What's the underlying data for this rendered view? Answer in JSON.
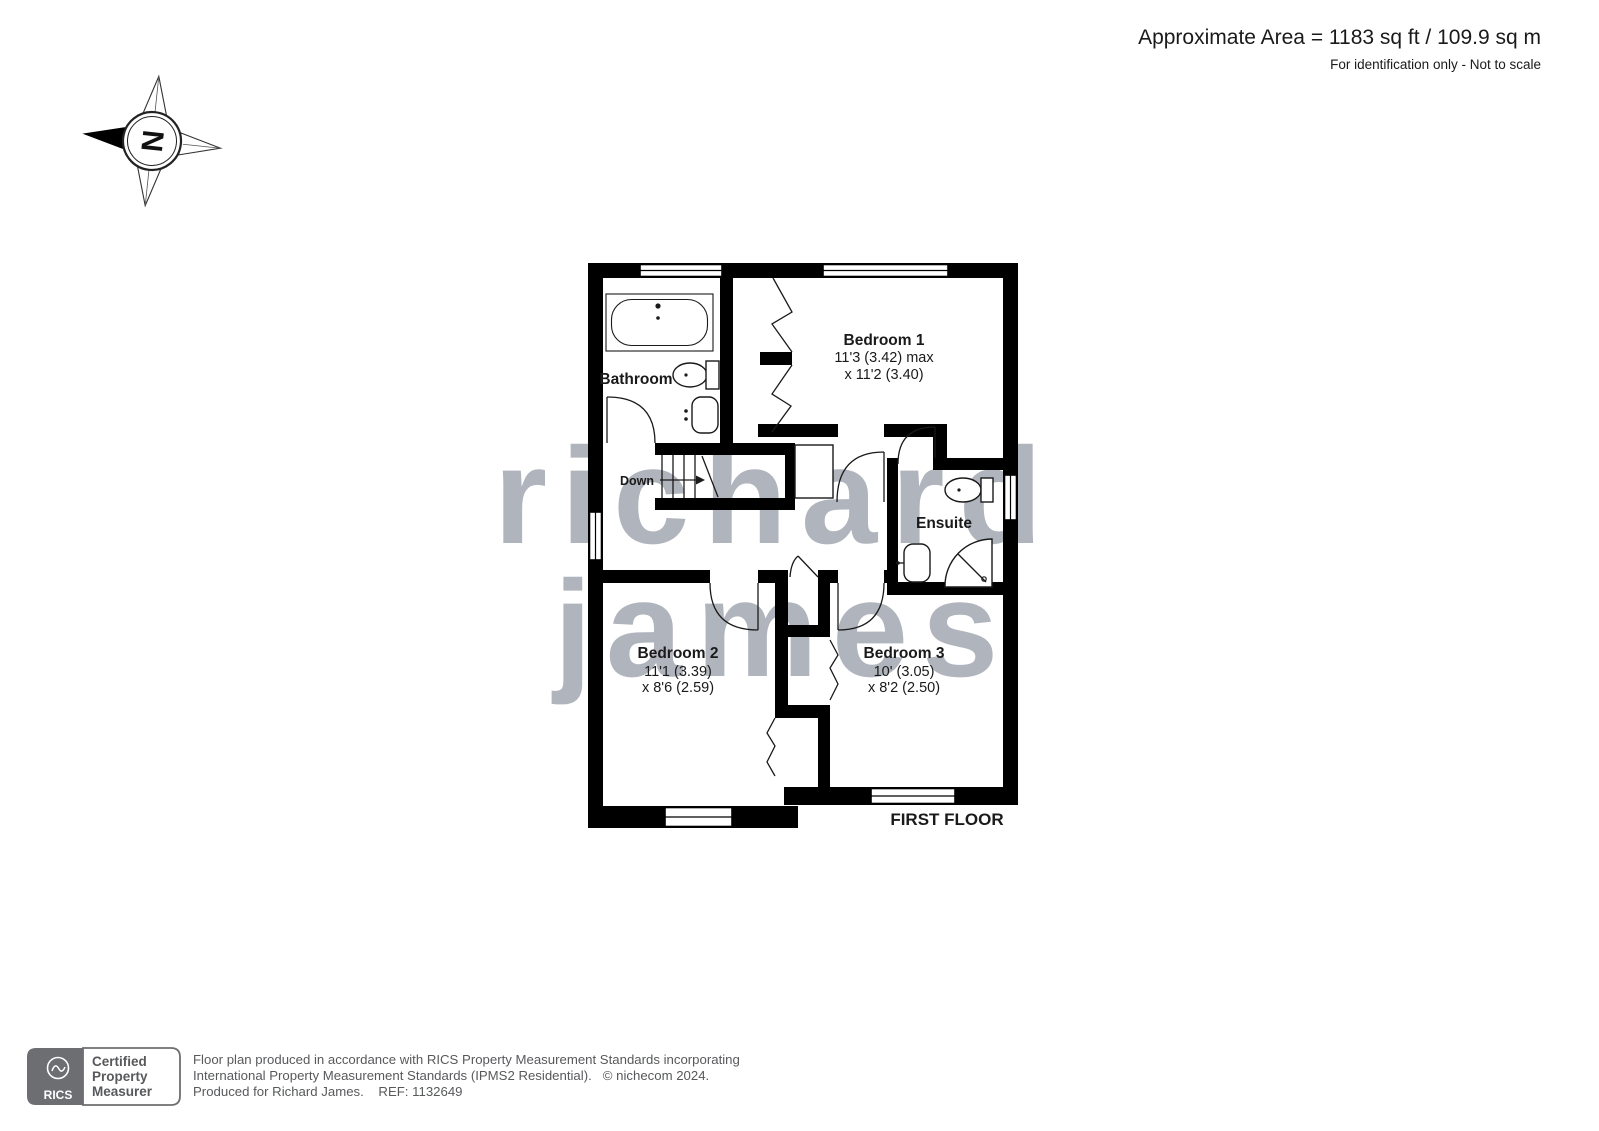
{
  "header": {
    "area": "Approximate Area = 1183 sq ft / 109.9 sq m",
    "disclaimer": "For identification only - Not to scale"
  },
  "compass": {
    "north_letter": "N"
  },
  "watermark": {
    "line1": "richard",
    "line2": "james"
  },
  "plan": {
    "floor_label": "FIRST FLOOR",
    "stairs_label": "Down",
    "rooms": {
      "bathroom": {
        "name": "Bathroom"
      },
      "bedroom1": {
        "name": "Bedroom 1",
        "dim_line1": "11'3 (3.42) max",
        "dim_line2": "x 11'2 (3.40)"
      },
      "ensuite": {
        "name": "Ensuite"
      },
      "bedroom2": {
        "name": "Bedroom 2",
        "dim_line1": "11'1 (3.39)",
        "dim_line2": "x 8'6 (2.59)"
      },
      "bedroom3": {
        "name": "Bedroom 3",
        "dim_line1": "10' (3.05)",
        "dim_line2": "x 8'2 (2.50)"
      }
    }
  },
  "footer": {
    "rics_logo_text": "RICS",
    "badge_line1": "Certified",
    "badge_line2": "Property",
    "badge_line3": "Measurer",
    "line1": "Floor plan produced in accordance with RICS Property Measurement Standards incorporating",
    "line2": "International Property Measurement Standards (IPMS2 Residential).   © nichecom 2024.",
    "line3": "Produced for Richard James.    REF: 1132649"
  },
  "colors": {
    "wall": "#000000",
    "watermark": "#b0b4bc",
    "footer_text": "#58595b",
    "rics_gray": "#6d6e71"
  }
}
